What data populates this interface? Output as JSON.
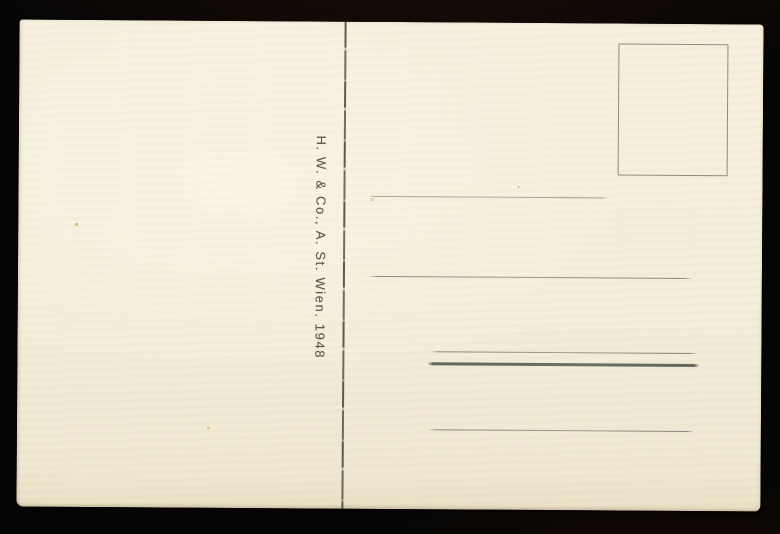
{
  "scene": {
    "description_colors": {
      "background": "#060505",
      "paper": "#f4eeda",
      "imprint_ink": "#55554f",
      "rule_thin": "#7a776c",
      "rule_thick": "#5a5f55",
      "divider": "#40403a",
      "stamp_box_border": "#676255"
    }
  },
  "postcard": {
    "publisher_imprint": "H. W. & Co., A. St. Wien. 1948",
    "address_rule_count": "5"
  }
}
